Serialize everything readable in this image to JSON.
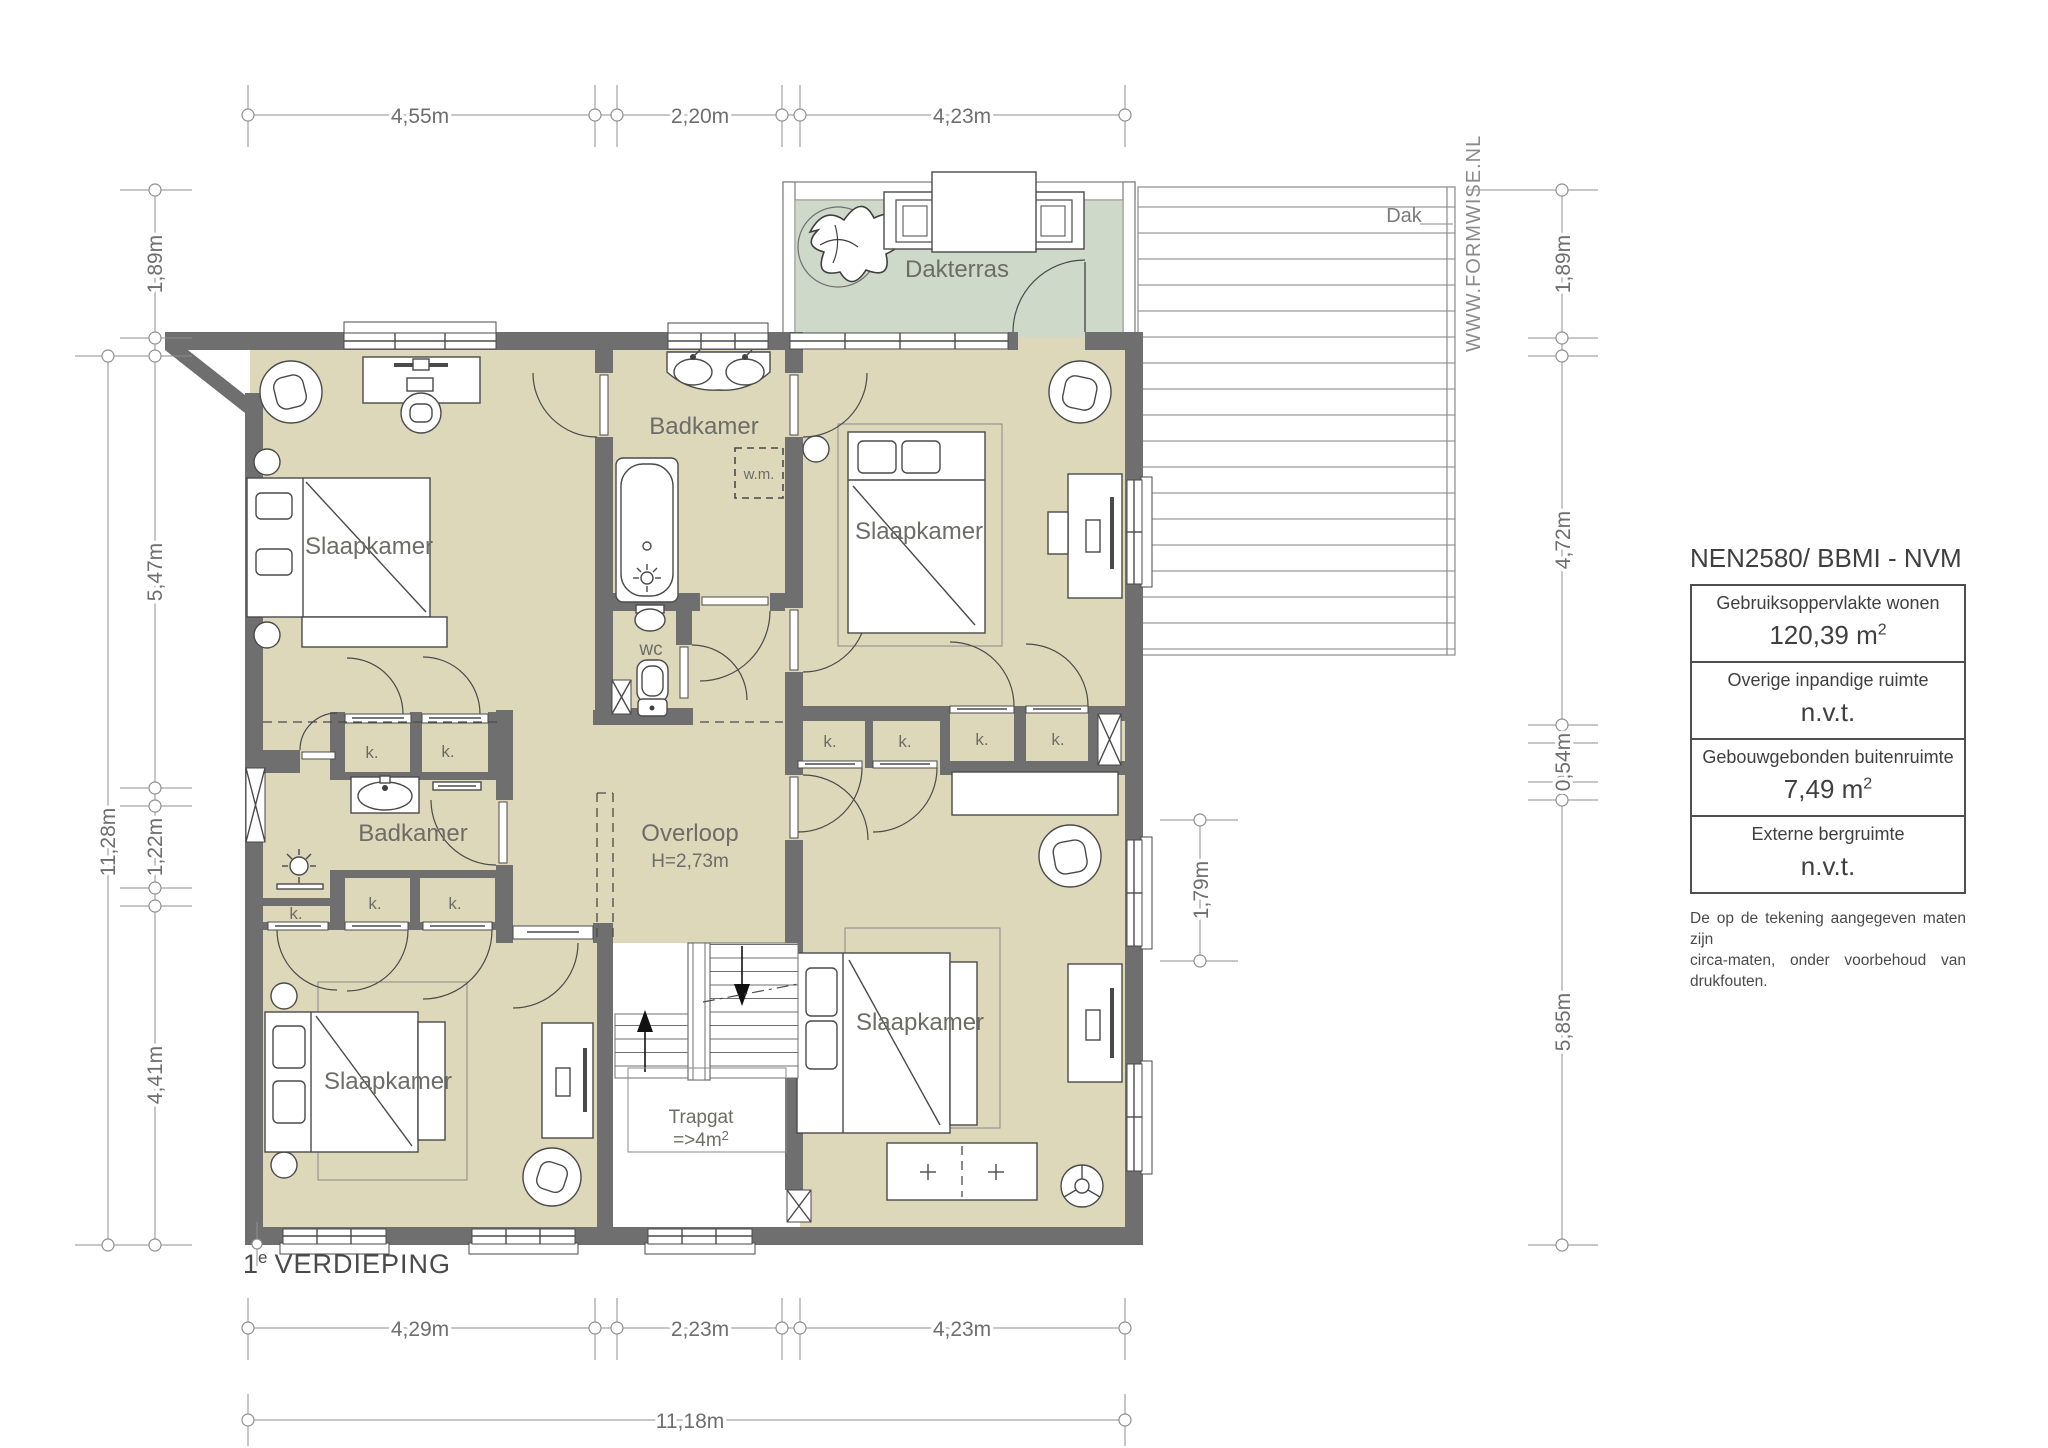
{
  "floor_label": {
    "num": "1",
    "sup": "e",
    "rest": "VERDIEPING"
  },
  "watermark": "WWW.FORMWISE.NL",
  "rooms": {
    "bedroom_top_left": "Slaapkamer",
    "bedroom_top_right": "Slaapkamer",
    "bedroom_bottom_left": "Slaapkamer",
    "bedroom_bottom_right": "Slaapkamer",
    "bathroom_top": "Badkamer",
    "bathroom_left": "Badkamer",
    "landing": "Overloop",
    "landing_height": "H=2,73m",
    "wc": "wc",
    "terrace": "Dakterras",
    "roof": "Dak",
    "stairwell": "Trapgat",
    "stairwell_area_main": "=>4m",
    "stairwell_area_sup": "2",
    "washing_machine": "w.m.",
    "closet": "k."
  },
  "dimensions": {
    "top": [
      "4,55m",
      "2,20m",
      "4,23m"
    ],
    "bottom": [
      "4,29m",
      "2,23m",
      "4,23m"
    ],
    "bottom_total": "11,18m",
    "left": [
      "1,89m",
      "5,47m",
      "1,22m",
      "4,41m"
    ],
    "left_total": "11,28m",
    "right": [
      "1,89m",
      "4,72m",
      "0,54m",
      "5,85m"
    ],
    "right_window": "1,79m"
  },
  "info_box": {
    "title": "NEN2580/ BBMI - NVM",
    "rows": [
      {
        "label": "Gebruiksoppervlakte wonen",
        "value": "120,39 m",
        "sup": "2"
      },
      {
        "label": "Overige inpandige ruimte",
        "value": "n.v.t.",
        "sup": ""
      },
      {
        "label": "Gebouwgebonden buitenruimte",
        "value": "7,49 m",
        "sup": "2"
      },
      {
        "label": "Externe bergruimte",
        "value": "n.v.t.",
        "sup": ""
      }
    ],
    "disclaimer_line1": "De op de tekening aangegeven maten zijn",
    "disclaimer_line2": "circa-maten, onder voorbehoud van drukfouten."
  },
  "colors": {
    "wall": "#6f6f6f",
    "floor": "#ded8ba",
    "terrace": "#cfd9ca",
    "dim_line": "#8f8f8f",
    "label_text": "#6d6d68"
  }
}
